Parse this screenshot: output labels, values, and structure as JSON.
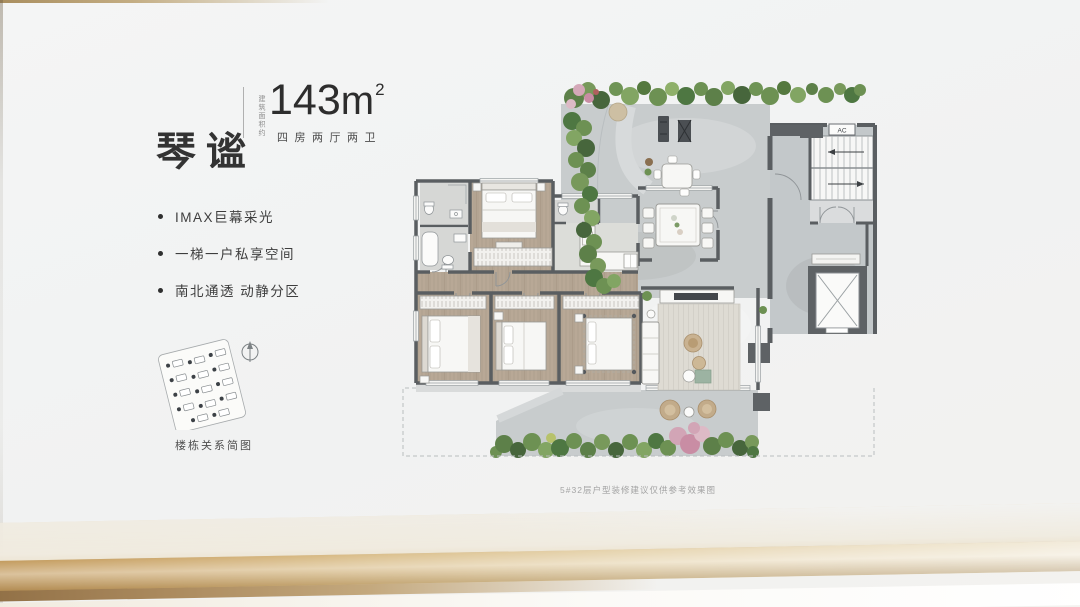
{
  "header": {
    "title": "琴谧",
    "area_prefix": "建筑面积约",
    "area_number": "143",
    "area_unit": "m",
    "area_exponent": "2",
    "rooms": "四房两厅两卫"
  },
  "features": [
    "IMAX巨幕采光",
    "一梯一户私享空间",
    "南北通透 动静分区"
  ],
  "site_map": {
    "caption": "楼栋关系简图"
  },
  "floor_plan": {
    "ac_label": "AC",
    "disclaimer": "5#32层户型装修建议仅供参考效果图"
  },
  "colors": {
    "gold_accent": "#c9a76c",
    "wall": "#5a5e61",
    "wood_floor": "#b3a492",
    "stone_floor": "#c8cccd",
    "greenery": "#6d9153",
    "blossom": "#d2a5b6"
  }
}
